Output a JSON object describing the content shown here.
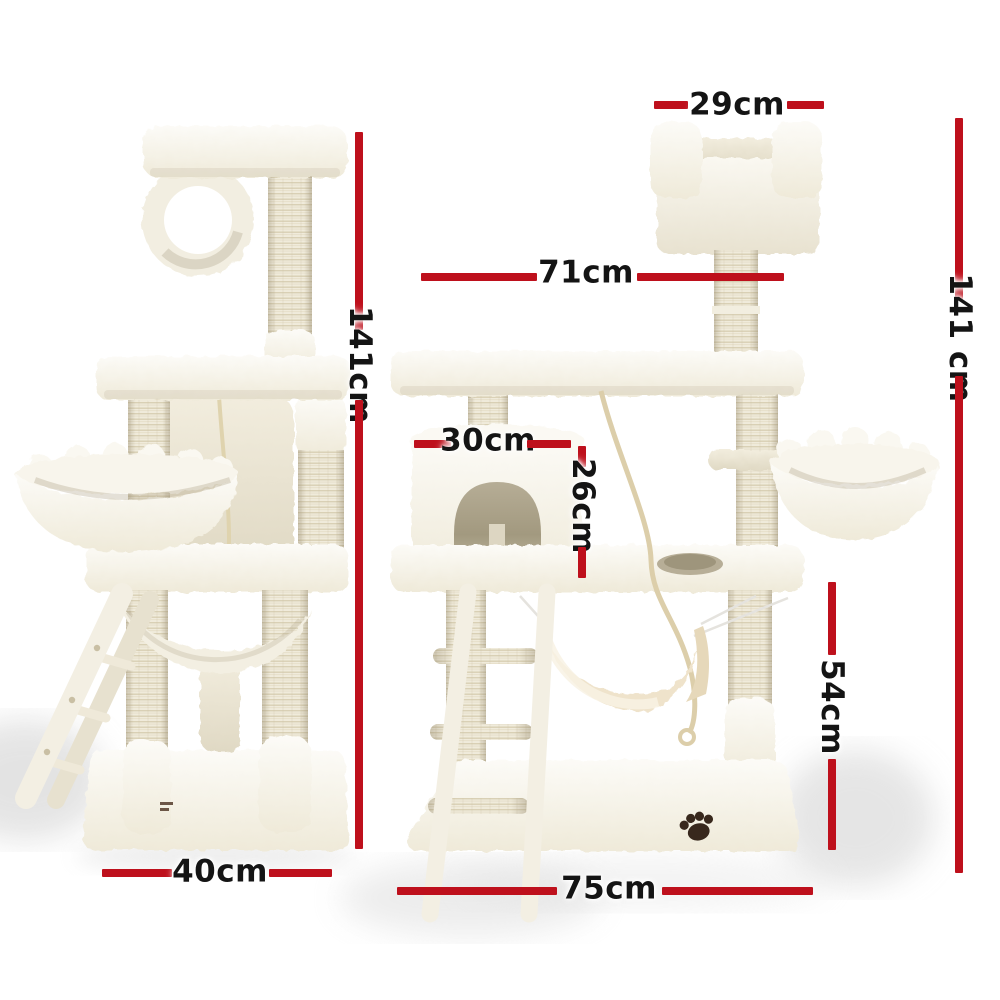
{
  "page": {
    "background": "#ffffff"
  },
  "colors": {
    "background": "#ffffff",
    "dimension_line": "#be101c",
    "label_text": "#141414"
  },
  "dimensions": {
    "top_perch_width": "29cm",
    "upper_platform_width": "71cm",
    "overall_height_side_view": "141cm",
    "overall_height_front_view": "141 cm",
    "condo_width": "30cm",
    "condo_height": "26cm",
    "lower_section_height": "54cm",
    "base_depth": "40cm",
    "base_width": "75cm"
  }
}
